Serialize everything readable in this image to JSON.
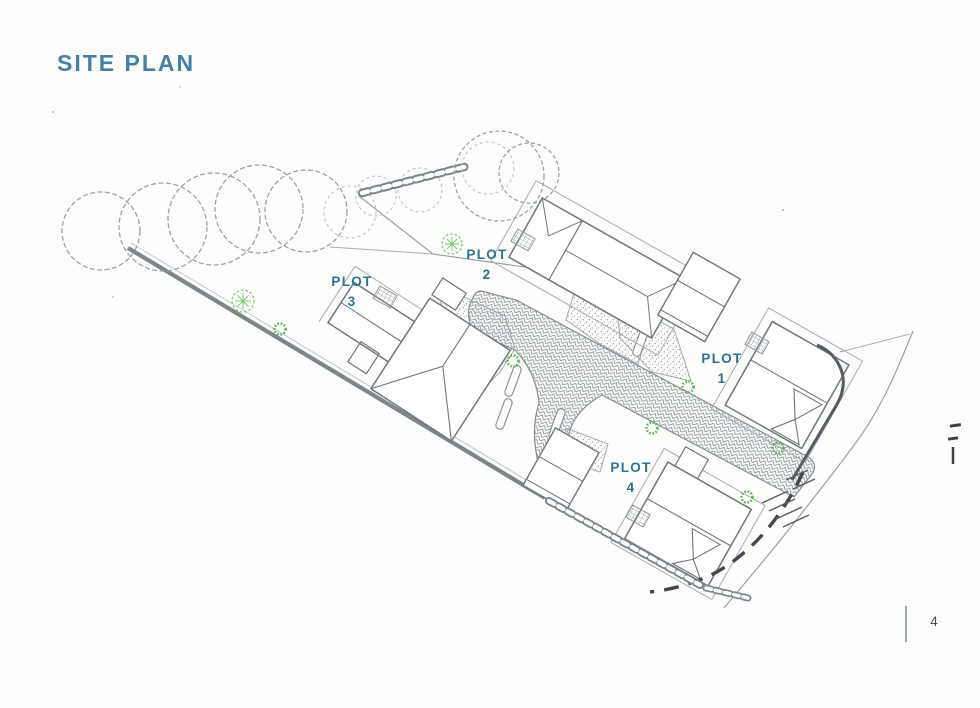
{
  "page": {
    "title": "SITE PLAN",
    "page_number": "4"
  },
  "colors": {
    "title_teal": "#4581a5",
    "label_teal": "#2a7391",
    "line_gray": "#6f767c",
    "tree_gray": "#9ba4a9",
    "shrub_green": "#59b553",
    "tree_symbol_green": "#7bc96f",
    "boundary_gray": "#7f868b",
    "dark_gray": "#565c61"
  },
  "plan": {
    "plots": [
      {
        "label": "PLOT",
        "number": "1"
      },
      {
        "label": "PLOT",
        "number": "2"
      },
      {
        "label": "PLOT",
        "number": "3"
      },
      {
        "label": "PLOT",
        "number": "4"
      }
    ]
  }
}
